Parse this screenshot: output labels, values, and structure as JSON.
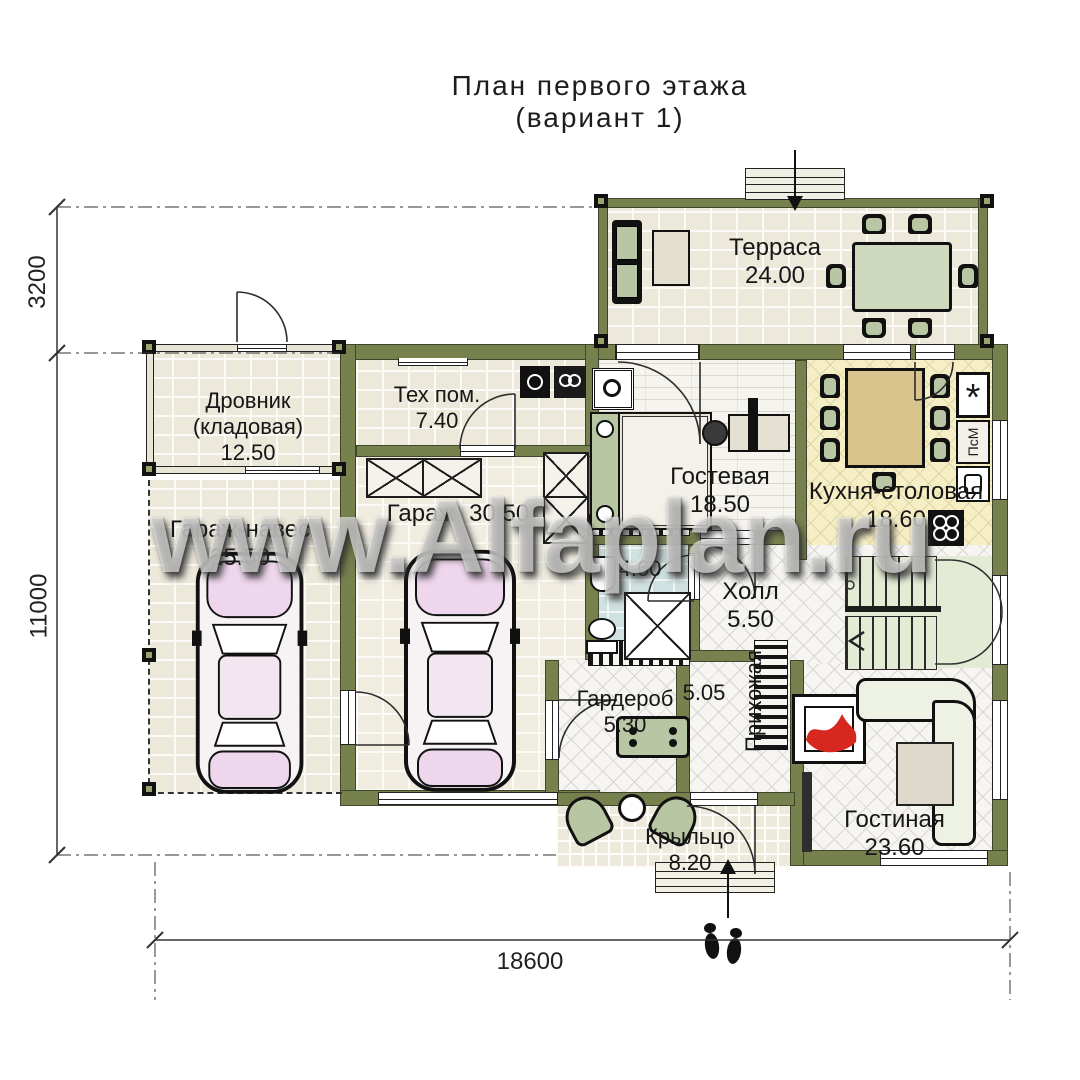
{
  "title": {
    "line1": "План первого этажа",
    "line2": "(вариант 1)"
  },
  "watermark": "www.Alfaplan.ru",
  "dimensions": {
    "left_top": "3200",
    "left_total": "11000",
    "bottom_total": "18600"
  },
  "rooms": {
    "terrace": {
      "name": "Терраса",
      "area": "24.00"
    },
    "drovnik": {
      "name_line1": "Дровник",
      "name_line2": "(кладовая)",
      "area": "12.50"
    },
    "carport": {
      "name": "Гараж-навес",
      "area": "25.50"
    },
    "tech": {
      "name": "Тех пом.",
      "area": "7.40"
    },
    "garage": {
      "name": "Гараж",
      "area": "30.50"
    },
    "guest": {
      "name": "Гостевая",
      "area": "18.50"
    },
    "kitchen": {
      "name": "Кухня-столовая",
      "area": "18.60"
    },
    "bathroom": {
      "area": "4.60"
    },
    "hall": {
      "name": "Холл",
      "area": "5.50"
    },
    "wardrobe": {
      "name": "Гардероб",
      "area": "5.30"
    },
    "hallway": {
      "name": "Прихожая",
      "area": "5.05"
    },
    "living": {
      "name": "Гостиная",
      "area": "23.60"
    },
    "porch": {
      "name": "Крыльцо",
      "area": "8.20"
    }
  },
  "appliances": {
    "dishwasher_label": "ПсМ",
    "fridge_symbol": "*"
  },
  "colors": {
    "wall_olive": "#77814e",
    "kitchen_floor": "#f6efc6",
    "bath_floor": "#cfe1e0",
    "flame_red": "#d6281e",
    "car_pink": "#eed6ec"
  }
}
